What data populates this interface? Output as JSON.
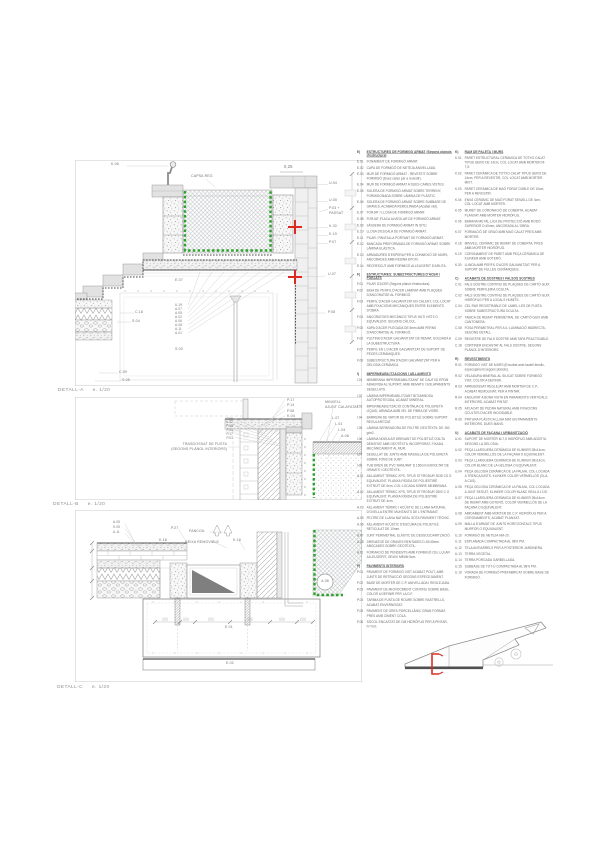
{
  "colors": {
    "line": "#9a9a9a",
    "light_line": "#cfcfcf",
    "dark_line": "#555555",
    "green_dashed": "#2fa12f",
    "red_marker": "#dd2a20",
    "label_text": "#767676"
  },
  "details": {
    "a": {
      "caption": {
        "name": "DETALL-A",
        "scale": "e. 1/20"
      },
      "labels": [
        {
          "t": "K.06",
          "x": 36,
          "y": 3
        },
        {
          "t": "CAPSA REG",
          "x": 116,
          "y": 15
        },
        {
          "t": "0,25",
          "x": 209,
          "y": 5,
          "fs": 4.2
        },
        {
          "t": "U.04",
          "x": 254,
          "y": 22
        },
        {
          "t": "U.05",
          "x": 254,
          "y": 39
        },
        {
          "t": "P.03 +",
          "x": 254,
          "y": 46.5
        },
        {
          "t": "PASSAT",
          "x": 254,
          "y": 51.5
        },
        {
          "t": "K.30",
          "x": 254,
          "y": 65
        },
        {
          "t": "K.19",
          "x": 254,
          "y": 73
        },
        {
          "t": "P.07",
          "x": 254,
          "y": 81
        },
        {
          "t": "U.07",
          "x": 253,
          "y": 113
        },
        {
          "t": "P.08",
          "x": 253,
          "y": 150.5
        },
        {
          "t": "C.18",
          "x": 60,
          "y": 150.5
        },
        {
          "t": "S.04",
          "x": 57,
          "y": 159.5
        },
        {
          "t": "E.07",
          "x": 100,
          "y": 119
        },
        {
          "t": "U.19",
          "x": 100,
          "y": 143.5,
          "fs": 3.2
        },
        {
          "t": "A.07",
          "x": 100,
          "y": 147.5,
          "fs": 3.2
        },
        {
          "t": "A.05",
          "x": 100,
          "y": 151.5,
          "fs": 3.2
        },
        {
          "t": "A.02",
          "x": 100,
          "y": 155.5,
          "fs": 3.2
        },
        {
          "t": "A.06",
          "x": 100,
          "y": 159.5,
          "fs": 3.2
        },
        {
          "t": "A.08",
          "x": 100,
          "y": 163.5,
          "fs": 3.2
        },
        {
          "t": "A.11",
          "x": 100,
          "y": 167.5,
          "fs": 3.2
        },
        {
          "t": "A.01",
          "x": 100,
          "y": 171.5,
          "fs": 3.2
        },
        {
          "t": "S.00",
          "x": 100,
          "y": 188
        },
        {
          "t": "C.09",
          "x": 44,
          "y": 210.5
        },
        {
          "t": "S.05",
          "x": 47,
          "y": 218.5
        }
      ]
    },
    "b": {
      "caption": {
        "name": "DETALL-B",
        "scale": "e. 1/20"
      },
      "labels": [
        {
          "t": "P.17",
          "x": 212,
          "y": 1.5
        },
        {
          "t": "P.14",
          "x": 212,
          "y": 7
        },
        {
          "t": "P.08",
          "x": 212,
          "y": 12.5
        },
        {
          "t": "K.04",
          "x": 212,
          "y": 18
        },
        {
          "t": "P.06",
          "x": 158,
          "y": 20.5,
          "al": "r",
          "fs": 3.2
        },
        {
          "t": "K.02",
          "x": 158,
          "y": 24.3,
          "al": "r",
          "fs": 3.2
        },
        {
          "t": "P.05",
          "x": 158,
          "y": 28.1,
          "al": "r",
          "fs": 3.2
        },
        {
          "t": "P.04",
          "x": 158,
          "y": 31.9,
          "al": "r",
          "fs": 3.2
        },
        {
          "t": "P.17",
          "x": 158,
          "y": 35.7,
          "al": "r",
          "fs": 3.2
        },
        {
          "t": "P.01",
          "x": 158,
          "y": 39.5,
          "al": "r",
          "fs": 3.2
        },
        {
          "t": "TRASDOSSAT DE FUSTA",
          "x": 152,
          "y": 45.5,
          "al": "r"
        },
        {
          "t": "(SEGONS PLÀNOL INTERIORS)",
          "x": 152,
          "y": 50.5,
          "al": "r"
        },
        {
          "t": "MINVELL",
          "x": 250,
          "y": 4
        },
        {
          "t": "AJUNT CALAFATAT",
          "x": 250,
          "y": 9
        },
        {
          "t": "L.07",
          "x": 257,
          "y": 19.5
        },
        {
          "t": "L.01",
          "x": 260,
          "y": 25.5
        },
        {
          "t": "L.04",
          "x": 263,
          "y": 31.5
        },
        {
          "t": "A.08",
          "x": 266,
          "y": 37.5
        }
      ]
    },
    "c": {
      "caption": {
        "name": "DETALL-C",
        "scale": "e. 1/20"
      },
      "labels": [
        {
          "t": "A.05",
          "x": 38,
          "y": 11,
          "fs": 3.2
        },
        {
          "t": "K.05",
          "x": 38,
          "y": 16,
          "fs": 3.2
        },
        {
          "t": "A.11",
          "x": 38,
          "y": 21,
          "fs": 3.2
        },
        {
          "t": "P.27",
          "x": 96,
          "y": 17
        },
        {
          "t": "K.18",
          "x": 84,
          "y": 28.5
        },
        {
          "t": "K.18",
          "x": 158,
          "y": 28.5
        },
        {
          "t": "FANCOIL",
          "x": 114,
          "y": 20
        },
        {
          "t": "REIXA REMOVIBLE",
          "x": 110,
          "y": 31
        },
        {
          "t": "A.08",
          "x": 250,
          "y": 72,
          "al": "c"
        },
        {
          "t": "E.01",
          "x": 150,
          "y": 115.5
        },
        {
          "t": "E.02",
          "x": 151,
          "y": 151.5
        }
      ]
    }
  },
  "legend": {
    "columns": [
      [
        {
          "code": "E)",
          "title": "ESTRUCTURES DE FORMIGÓ ARMAT (Segons plànols d'estructura)",
          "items": [
            {
              "c": "E.01",
              "t": "FONAMENT DE FORMIGÓ ARMAT."
            },
            {
              "c": "E.02",
              "t": "CAPA DE FORMIGÓ DE NETEJA ANIVELLADA."
            },
            {
              "c": "E.03",
              "t": "MUR DE FORMIGÓ ARMAT - REVESTIT SOBRE FORMIGÓ (Dues cares per a revestir)."
            },
            {
              "c": "E.04",
              "t": "MUR DE FORMIGÓ ARMAT A DUES CARES VISTES."
            },
            {
              "c": "E.05",
              "t": "SOLERA DE FORMIGÓ ARMAT SOBRE TERRENY, FORMIGONADA SOBRE LÀMINA DE PLÀSTIC."
            },
            {
              "c": "E.06",
              "t": "SOLERA DE FORMIGÓ ARMAT SOBRE SUBBASE DE GRAVES, ACABADA REMOLINADA (Acabat vist)."
            },
            {
              "c": "E.07",
              "t": "FORJAT / LLOSA DE FORMIGÓ ARMAT."
            },
            {
              "c": "E.08",
              "t": "FORJAT-PLACA ALVEOLAR DE FORMIGÓ ARMAT."
            },
            {
              "c": "E.09",
              "t": "JÀSSERA DE FORMIGÓ ARMAT IN SITU."
            },
            {
              "c": "E.10",
              "t": "LLOSA D'ESCALA DE FORMIGÓ ARMAT."
            },
            {
              "c": "E.11",
              "t": "PILAR / PANTALLA PORTANT DE FORMIGÓ ARMAT."
            },
            {
              "c": "E.12",
              "t": "BANCADA PREFORMADA DE FORMIGÓ ARMAT SOBRE LÀMINA ELÀSTICA."
            },
            {
              "c": "E.13",
              "t": "ARMADURES D'ESPERA PER A CONNEXIÓ DE MURS, ANCORADES AMB RESINA EPOXI."
            },
            {
              "c": "E.14",
              "t": "RECRESCUT AMB FORMIGÓ ALLEUGERIT D'ARLITA."
            }
          ]
        },
        {
          "code": "F)",
          "title": "ESTRUCTURES: SUBESTRUCTURES D'ACER I FORJATS",
          "items": [
            {
              "c": "F.01",
              "t": "PILAR D'ACER (Segons plànol d'estructura)."
            },
            {
              "c": "F.02",
              "t": "BIGA DE PERFIL D'ACER LAMINAT AMB PLAQUES D'ANCORATGE AL FORMIGÓ."
            },
            {
              "c": "F.03",
              "t": "PERFIL D'ACER GALVANITZAT EN CALENT, COL·LOCAT AMB FIXACIONS MECÀNIQUES ENTRE ELEMENTS D'OBRA."
            },
            {
              "c": "F.04",
              "t": "ANCORATGES MECÀNICS TIPUS HILTI HST3 O EQUIVALENT, SEGONS CÀLCUL."
            },
            {
              "c": "F.05",
              "t": "XAPA D'ACER PLEGADA DE 8mm AMB PERNS D'ANCORATGE AL FORMIGÓ."
            },
            {
              "c": "F.06",
              "t": "PLETINA D'ACER GALVANITZAT DE REMAT, SOLDADA A LA SUBESTRUCTURA."
            },
            {
              "c": "F.07",
              "t": "PERFIL EN L D'ACER GALVANITZAT DE SUPORT DE PECES CERÀMIQUES."
            },
            {
              "c": "F.08",
              "t": "SUBESTRUCTURA D'ACER GALVANITZAT PER A GELOSIA CERÀMICA."
            }
          ]
        },
        {
          "code": "I)",
          "title": "IMPERMEABILITZACIONS I AÏLLAMENTS",
          "items": [
            {
              "c": "I.01",
              "t": "MEMBRANA IMPERMEABILITZANT DE CAUTXÚ EPDM ADHERIDA AL SUPORT, AMB REMATS I SOLAPAMENTS SEGELLATS."
            },
            {
              "c": "I.02",
              "t": "LÀMINA IMPERMEABILITZANT BITUMINOSA AUTOPROTEGIDA, ACABAT MINERAL."
            },
            {
              "c": "I.03",
              "t": "IMPERMEABILITZACIÓ CONTÍNUA DE POLIURETÀ LÍQUID, ARMADA AMB VEL DE FIBRA DE VIDRE."
            },
            {
              "c": "I.04",
              "t": "BARRERA DE VAPOR DE POLIETILÈ SOBRE SUPORT REGULARITZAT."
            },
            {
              "c": "I.05",
              "t": "LÀMINA SEPARADORA DE FELTRE GEOTÈXTIL DE 150 g/m2."
            },
            {
              "c": "I.06",
              "t": "LÀMINA NODULAR DRENANT DE POLIETILÈ D'ALTA DENSITAT AMB GEOTÈXTIL INCORPORAT, FIXADA MECÀNICAMENT AL MUR."
            },
            {
              "c": "I.07",
              "t": "SEGELLAT DE JUNTS AMB MASSILLA DE POLIURETÀ SOBRE FONS DE JUNT."
            },
            {
              "c": "I.08",
              "t": "TUB DREN DE PVC RANURAT D.150mm ENVOLTAT DE GRAVES I GEOTÈXTIL."
            },
            {
              "c": "A.01",
              "t": "AÏLLAMENT TÈRMIC XPS, TIPUS STYRODUR 3035 CS O EQUIVALENT, PLANXA RÍGIDA DE POLIESTIRÈ EXTRUÏT DE 6cm, COL·LOCADA SOBRE MEMBRANA."
            },
            {
              "c": "A.02",
              "t": "AÏLLAMENT TÈRMIC XPS, TIPUS STYRODUR 2500 C O EQUIVALENT, PLANXA RÍGIDA DE POLIESTIRÈ EXTRUÏT DE 4cm."
            },
            {
              "c": "A.03",
              "t": "AÏLLAMENT TÈRMIC I ACÚSTIC DE LLANA NATURAL D'OVELLA ENTRE MUNTANTS DE L'ENTRAMAT."
            },
            {
              "c": "A.05",
              "t": "FELTRE DE LLANA NATURAL SOTA PAVIMENT TÈCNIC."
            },
            {
              "c": "A.06",
              "t": "AÏLLAMENT ACÚSTIC D'ESCUMA DE POLIETILÈ RETICULAT DE 10mm."
            },
            {
              "c": "A.07",
              "t": "JUNT PERIMETRAL ELÀSTIC DE DESSOLIDARITZACIÓ."
            },
            {
              "c": "A.08",
              "t": "DRENATGE DE GRAVES RENTADES D.20/40mm ABOCADES SOBRE GEOTÈXTIL."
            },
            {
              "c": "A.11",
              "t": "FORMACIÓ DE PENDENTS AMB FORMIGÓ CEL·LULAR ALLEUGERIT, GRUIX MÍNIM 5cm."
            }
          ]
        },
        {
          "code": "P)",
          "title": "PAVIMENTS INTERIORS",
          "items": [
            {
              "c": "P.01",
              "t": "PAVIMENT DE FORMIGÓ VIST ACABAT POLIT, AMB JUNTS DE RETRACCIÓ SEGONS ESPECEJAMENT."
            },
            {
              "c": "P.02",
              "t": "BASE DE MORTER DE C.P. ANIVELLADA I REGLEJADA."
            },
            {
              "c": "P.03",
              "t": "PAVIMENT DE MICROCIMENT CONTINU SOBRE BASE, COLOR A DEFINIR PER LA D.F."
            },
            {
              "c": "P.04",
              "t": "TARIMA DE FUSTA DE ROURE SOBRE RASTRELLS, ACABAT ENVERNISSAT."
            },
            {
              "c": "P.05",
              "t": "PAVIMENT DE GRES PORCELLÀNIC GRAN FORMAT, PRES AMB CIMENT COLA."
            },
            {
              "c": "P.06",
              "t": "SÒCOL ENCASTAT DE DM HIDRÒFUG PER A PINTAR, h=7cm."
            },
            {
              "c": "P.07",
              "t": "PAVIMENT EXTERIOR DE PECES CERÀMIQUES DE KLINKER COL·LOCADES A TRENCAJUNTS."
            },
            {
              "c": "P.08",
              "t": "PAVIMENT FLOTANT DE LLOSES PREFABRICADES SOBRE SUPORTS REGULABLES."
            }
          ]
        }
      ],
      [
        {
          "code": "K)",
          "title": "RAM DE PALETA I MURS",
          "items": [
            {
              "c": "K.01",
              "t": "PARET ESTRUCTURAL CERÀMICA DE TOTXO CALAT TIPUS GERO DE 14cm, COL·LOCAT AMB MORTER M-7,5."
            },
            {
              "c": "K.02",
              "t": "PARET CERÀMICA DE TOTXO CALAT TIPUS GERO DE 14cm, PER A REVESTIR, COL·LOCAT AMB MORTER MIXT."
            },
            {
              "c": "K.03",
              "t": "PARET CERÀMICA DE MAÓ FORAT DOBLE DE 10cm, PER A REVESTIR."
            },
            {
              "c": "K.04",
              "t": "ENVÀ CERÀMIC DE MAÓ FORAT SENZILL DE 4cm, COL·LOCAT AMB MORTER."
            },
            {
              "c": "K.05",
              "t": "MURET DE CORONACIÓ DE COBERTA, ACABAT PLANXAT AMB MORTER HIDRÒFUG."
            },
            {
              "c": "K.06",
              "t": "BARANA METÀL·LICA DE PROTECCIÓ AMB RODÓ SUPERIOR D.40mm, ANCORADA A L'OBRA."
            },
            {
              "c": "K.07",
              "t": "FORMACIÓ DE GRAÓ AMB MAÓ CALAT PRES AMB MORTER."
            },
            {
              "c": "K.18",
              "t": "MINVELL CERÀMIC DE REMAT DE COBERTA, PRES AMB MORTER HIDRÒFUG."
            },
            {
              "c": "K.19",
              "t": "CORONAMENT DE PARET AMB PEÇA CERÀMICA DE KLINKER AMB GOTERÓ."
            },
            {
              "c": "K.30",
              "t": "LLINDA AMB PERFIL D'ACER GALVANITZAT PER A SUPORT DE FULLES CERÀMIQUES."
            }
          ]
        },
        {
          "code": "C)",
          "title": "ACABATS DE SOSTRES I FALSOS SOSTRES",
          "items": [
            {
              "c": "C.01",
              "t": "FALS SOSTRE CONTINU DE PLAQUES DE CARTÓ-GUIX SOBRE PERFILERIA OCULTA."
            },
            {
              "c": "C.02",
              "t": "FALS SOSTRE CONTINU DE PLAQUES DE CARTÓ-GUIX HIDRÒFUG PER A LOCALS HUMITS."
            },
            {
              "c": "C.04",
              "t": "CEL RAS REGISTRABLE DE LAMEL·LES DE FUSTA SOBRE SUBESTRUCTURA OCULTA."
            },
            {
              "c": "C.07",
              "t": "TABICA DE REMAT PERIMETRAL DE CARTÓ-GUIX AMB CANTONERA."
            },
            {
              "c": "C.08",
              "t": "FOSA PERIMETRAL PER A IL·LUMINACIÓ INDIRECTA, SEGONS DETALL."
            },
            {
              "c": "C.09",
              "t": "REGISTRE DE FALS SOSTRE AMB TAPA PRACTICABLE."
            },
            {
              "c": "C.18",
              "t": "CORTINER ENCASTAT AL FALS SOSTRE, SEGONS PLÀNOL D'INTERIORS."
            }
          ]
        },
        {
          "code": "R)",
          "title": "REVESTIMENTS",
          "items": [
            {
              "c": "R.01",
              "t": "FORMIGÓ VIST DE MURS (Encofrat amb taulell fenòlic, especejament segons plànols)."
            },
            {
              "c": "R.02",
              "t": "VELADURA MINERAL AL SILICAT SOBRE FORMIGÓ VIST, COLOR A DEFINIR."
            },
            {
              "c": "R.03",
              "t": "ARREBOSSAT REGLEJAT AMB MORTER DE C.P., ACABAT REMOLINAT, PER A PINTAR."
            },
            {
              "c": "R.04",
              "t": "ENGUIXAT A BONA VISTA EN PARAMENTS VERTICALS INTERIORS, ACABAT PINTAT."
            },
            {
              "c": "R.05",
              "t": "APLACAT DE PEDRA NATURAL AMB FIXACIONS OCULTES D'ACER INOXIDABLE."
            },
            {
              "c": "R.06",
              "t": "PINTURA PLÀSTICA LLISA MAT EN PARAMENTS INTERIORS, DUES MANS."
            }
          ]
        },
        {
          "code": "U)",
          "title": "ACABATS DE FAÇANA I URBANITZACIÓ",
          "items": [
            {
              "c": "U.01",
              "t": "SUPORT DE MORTER M-7,5 HIDRÒFUG AMB ADDITIU, SEGONS LA GELOSIA."
            },
            {
              "c": "U.02",
              "t": "PEÇA LLARGUERA CERÀMICA DE KLINKER 28x14cm, COLOR VERMELLÓS DE LA FAÇANA O EQUIVALENT."
            },
            {
              "c": "U.03",
              "t": "PEÇA LLARGUERA CERÀMICA DE KLINKER 28x14cm, COLOR BLANC DE LA GELOSIA O EQUIVALENT."
            },
            {
              "c": "U.04",
              "t": "PEÇA GELOSIA CERÀMICA DE LA PALMA, COL·LOCADA A TRENCAJUNTS, KLINKER COLOR VERMELLÓS (GLA. A CUS)."
            },
            {
              "c": "U.05",
              "t": "PEÇA GELOSIA CERÀMICA DE LA PALMA, COL·LOCADA A JUNT SEGUIT, KLINKER COLOR BLANC REAL A L'ÚS."
            },
            {
              "c": "U.07",
              "t": "PEÇA LLARGUERA CERÀMICA DE KLINKER 28x14cm DE REMAT AMB GOTERÓ, COLOR VERMELLÓS DE LA FAÇANA O EQUIVALENT."
            },
            {
              "c": "U.08",
              "t": "AMIDAMENT AMB MORTER DE C.P. HIDRÒFUG PER A CORONAMENTS, ACABAT PLANXAT."
            },
            {
              "c": "U.09",
              "t": "MALLA D'ARMAT DE JUNTS HORITZONTALS TIPUS MURFOR O EQUIVALENT."
            },
            {
              "c": "U.10",
              "t": "FORMIGÓ DE NETEJA HM-20."
            },
            {
              "c": "U.11",
              "t": "ESPLANADA COMPACTADA AL 98% PM."
            },
            {
              "c": "U.12",
              "t": "TELA ANTIARRELS PER A POSTERIOR JARDINERA."
            },
            {
              "c": "U.13",
              "t": "TERRA VEGETAL."
            },
            {
              "c": "U.14",
              "t": "TERRA PORGADA GARBELLADA."
            },
            {
              "c": "U.15",
              "t": "SUBBASE DE TOT-Ú COMPACTADA AL 98% PM."
            },
            {
              "c": "U.19",
              "t": "VORADA DE FORMIGÓ PREFABRICAT SOBRE BASE DE FORMIGÓ."
            }
          ]
        }
      ]
    ]
  }
}
